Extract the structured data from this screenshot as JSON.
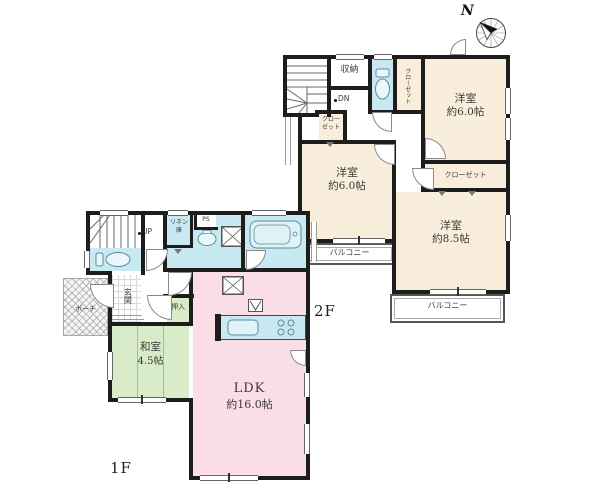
{
  "compass": {
    "north": "N"
  },
  "f2": {
    "label": "2F",
    "stairs_label": "DN",
    "storage_label": "収納",
    "closet_vertical_label": "クローゼット",
    "closet_small_line1": "クロー",
    "closet_small_line2": "ゼット",
    "closet_main_label": "クローゼット",
    "bedroom_ne": {
      "name": "洋室",
      "area": "約6.0帖"
    },
    "bedroom_w": {
      "name": "洋室",
      "area": "約6.0帖"
    },
    "bedroom_se": {
      "name": "洋室",
      "area": "約8.5帖"
    },
    "balcony_w_label": "バルコニー",
    "balcony_se_label": "バルコニー"
  },
  "f1": {
    "label": "1F",
    "stairs_label": "UP",
    "linen_line1": "リネン",
    "linen_line2": "庫",
    "ps_label": "PS",
    "entrance_label": "玄関",
    "porch_label": "ポーチ",
    "closet_label": "押入",
    "washitsu": {
      "name": "和室",
      "area": "4.5帖"
    },
    "ldk": {
      "name": "LDK",
      "area": "約16.0帖"
    }
  },
  "colors": {
    "wall": "#1d1d1b",
    "bedroom_cream": "#f8eedb",
    "water_blue": "#c9e9f2",
    "ldk_pink": "#fadde6",
    "tatami_green": "#d9ecc9"
  }
}
